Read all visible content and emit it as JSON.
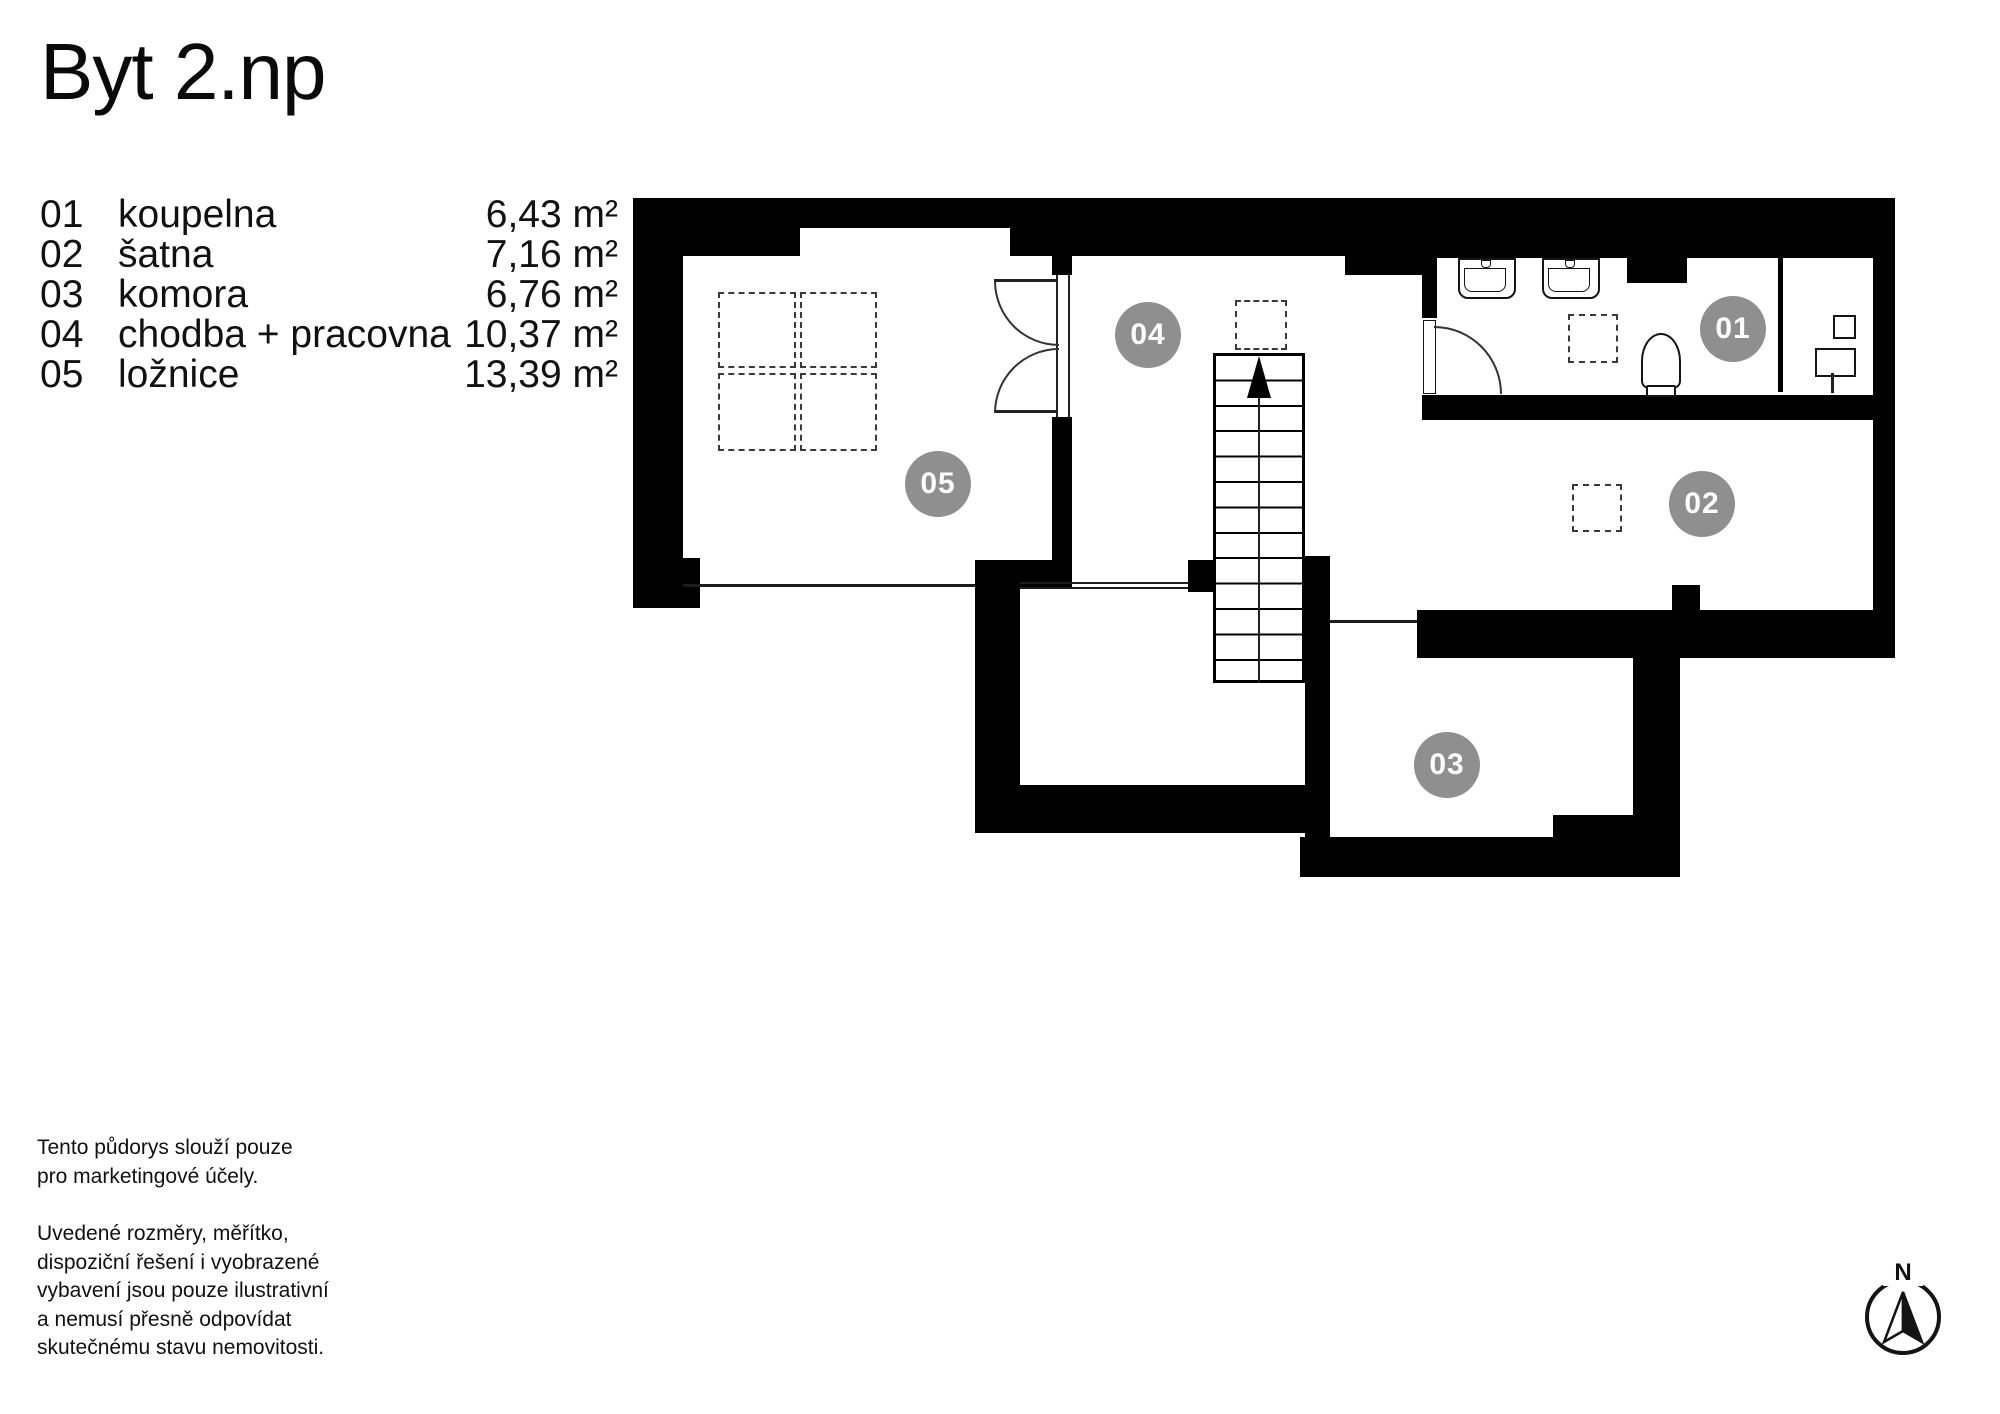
{
  "title": "Byt 2.np",
  "legend": {
    "rows": [
      {
        "num": "01",
        "name": "koupelna",
        "area": "6,43 m²"
      },
      {
        "num": "02",
        "name": "šatna",
        "area": "7,16 m²"
      },
      {
        "num": "03",
        "name": "komora",
        "area": "6,76 m²"
      },
      {
        "num": "04",
        "name": "chodba + pracovna",
        "area": "10,37 m²"
      },
      {
        "num": "05",
        "name": "ložnice",
        "area": "13,39 m²"
      }
    ]
  },
  "badges": {
    "b01": "01",
    "b02": "02",
    "b03": "03",
    "b04": "04",
    "b05": "05"
  },
  "disclaimer": {
    "para1": "Tento půdorys slouží pouze\npro marketingové účely.",
    "para2": "Uvedené rozměry, měřítko,\ndispoziční řešení i vyobrazené\nvybavení jsou pouze ilustrativní\na nemusí přesně odpovídat\nskutečnému stavu nemovitosti."
  },
  "compass": {
    "north_label": "N"
  },
  "colors": {
    "wall": "#000000",
    "badge_gray": "#8f8f8f",
    "text": "#111111"
  }
}
